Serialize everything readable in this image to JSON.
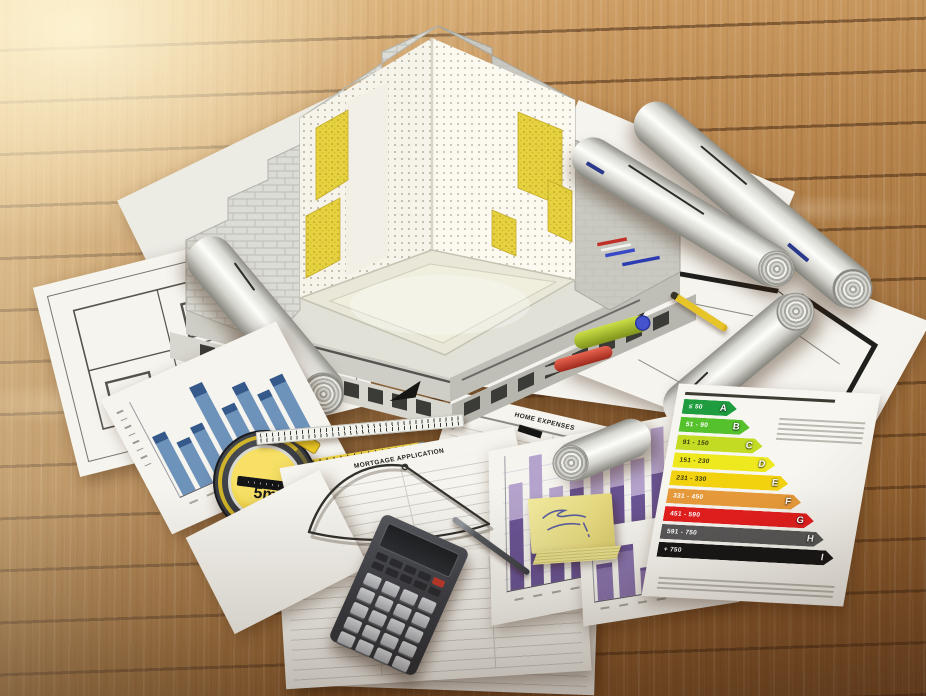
{
  "tape_measure": {
    "label": "5m",
    "case_color": "#2f3237",
    "face_color": "#eaca2b"
  },
  "forms": {
    "mortgage_application_title": "MORTGAGE APPLICATION",
    "home_expenses_title": "HOME EXPENSES"
  },
  "energy_label": {
    "rows": [
      {
        "letter": "A",
        "range": "≤ 50",
        "color": "#1f9c3f",
        "text": "#ffffff",
        "width": 54
      },
      {
        "letter": "B",
        "range": "51 - 90",
        "color": "#55c22d",
        "text": "#ffffff",
        "width": 70
      },
      {
        "letter": "C",
        "range": "91 - 150",
        "color": "#c3dc23",
        "text": "#3a3a10",
        "width": 86
      },
      {
        "letter": "D",
        "range": "151 - 230",
        "color": "#eee81e",
        "text": "#3a3a10",
        "width": 102
      },
      {
        "letter": "E",
        "range": "231 - 330",
        "color": "#f2d10f",
        "text": "#3a3a10",
        "width": 118
      },
      {
        "letter": "F",
        "range": "331 - 450",
        "color": "#e79a3a",
        "text": "#ffffff",
        "width": 134
      },
      {
        "letter": "G",
        "range": "451 - 590",
        "color": "#e31e1e",
        "text": "#ffffff",
        "width": 150
      },
      {
        "letter": "H",
        "range": "591 - 750",
        "color": "#585858",
        "text": "#ffffff",
        "width": 163
      },
      {
        "letter": "I",
        "range": "+ 750",
        "color": "#161616",
        "text": "#ffffff",
        "width": 176
      }
    ]
  },
  "chart_data": [
    {
      "type": "bar",
      "id": "blue_bars",
      "values": [
        62,
        48,
        55,
        90,
        60,
        74,
        58,
        66
      ],
      "bar_color": "#6e93bb",
      "accent": "#35598a"
    },
    {
      "type": "bar",
      "id": "purple_bars_large",
      "values": [
        78,
        96,
        70,
        100,
        86,
        93,
        79,
        99,
        88
      ],
      "bar_color": "#6a5494",
      "top_color": "#b4a3cc"
    },
    {
      "type": "bar",
      "id": "purple_bars_small",
      "values": [
        55,
        78,
        40,
        88,
        62,
        92
      ],
      "bar_color": "#8974ad",
      "accent": "#6a5494"
    }
  ],
  "palette": {
    "pipe_red": "#d7432f",
    "pipe_green": "#aec42f",
    "pipe_blue": "#4553cc",
    "insulation_yellow": "#e6d23f",
    "sticky_yellow": "#ece394"
  }
}
